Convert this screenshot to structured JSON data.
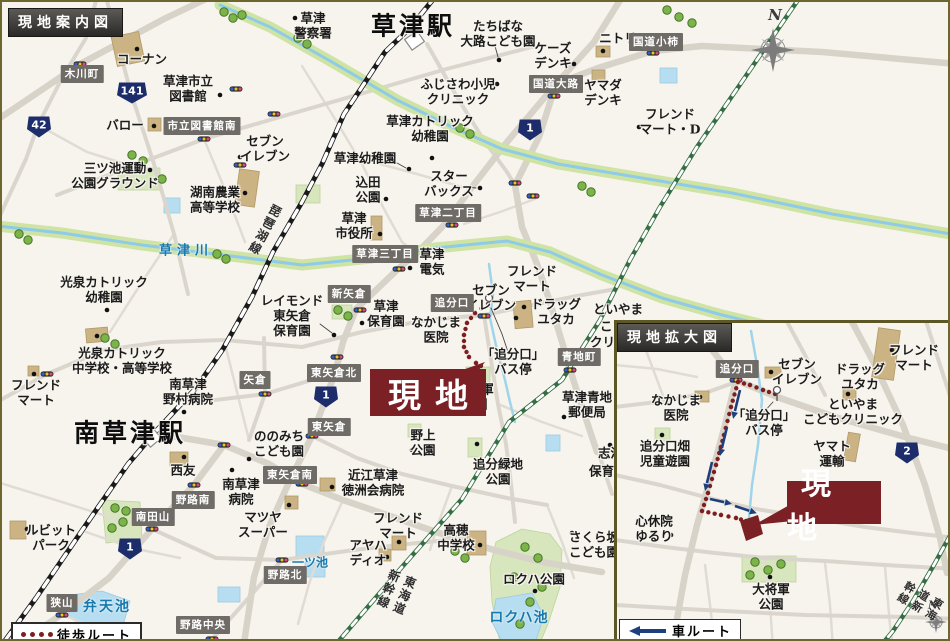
{
  "titles": {
    "main": "現地案内図",
    "inset": "現地拡大図"
  },
  "legends": {
    "walk": "徒歩ルート",
    "car": "車ルート"
  },
  "site": {
    "label": "現地"
  },
  "compass_label": "N",
  "colors": {
    "site_red": "#7b2025",
    "walk_route": "#7e1e1e",
    "car_route": "#1e3f7d",
    "shield_blue": "#1d2c6b",
    "water_text": "#1879ad",
    "river_band": "#cfe3a3",
    "rail_jr": "#1a1a1a",
    "rail_shinkansen": "#356e44"
  },
  "main_map": {
    "stations": [
      {
        "t": "草津駅",
        "x": 411,
        "y": 24
      },
      {
        "t": "南草津駅",
        "x": 128,
        "y": 431
      }
    ],
    "places": [
      {
        "lines": [
          "草津",
          "警察署"
        ],
        "x": 311,
        "y": 24
      },
      {
        "lines": [
          "たちばな",
          "大路こども園"
        ],
        "x": 496,
        "y": 32
      },
      {
        "lines": [
          "ケーズ",
          "デンキ"
        ],
        "x": 551,
        "y": 54
      },
      {
        "lines": [
          "ニトリ"
        ],
        "x": 616,
        "y": 37
      },
      {
        "lines": [
          "ヤマダ",
          "デンキ"
        ],
        "x": 601,
        "y": 91
      },
      {
        "lines": [
          "フレンド",
          "マート・D"
        ],
        "x": 668,
        "y": 120
      },
      {
        "lines": [
          "コーナン"
        ],
        "x": 140,
        "y": 58
      },
      {
        "lines": [
          "草津市立",
          "図書館"
        ],
        "x": 186,
        "y": 87
      },
      {
        "lines": [
          "バロー"
        ],
        "x": 123,
        "y": 124
      },
      {
        "lines": [
          "セブン",
          "イレブン"
        ],
        "x": 263,
        "y": 147
      },
      {
        "lines": [
          "三ツ池運動",
          "公園グラウンド"
        ],
        "x": 113,
        "y": 174
      },
      {
        "lines": [
          "湖南農業",
          "高等学校"
        ],
        "x": 213,
        "y": 198
      },
      {
        "lines": [
          "ふじさわ小児",
          "クリニック"
        ],
        "x": 456,
        "y": 90
      },
      {
        "lines": [
          "草津カトリック",
          "幼稚園"
        ],
        "x": 428,
        "y": 127
      },
      {
        "lines": [
          "草津幼稚園"
        ],
        "x": 363,
        "y": 157
      },
      {
        "lines": [
          "込田",
          "公園"
        ],
        "x": 366,
        "y": 188
      },
      {
        "lines": [
          "スター",
          "バックス"
        ],
        "x": 447,
        "y": 182
      },
      {
        "lines": [
          "草津",
          "市役所"
        ],
        "x": 352,
        "y": 224
      },
      {
        "lines": [
          "草津",
          "電気"
        ],
        "x": 430,
        "y": 260
      },
      {
        "lines": [
          "光泉カトリック",
          "幼稚園"
        ],
        "x": 102,
        "y": 288
      },
      {
        "lines": [
          "光泉カトリック",
          "中学校・高等学校"
        ],
        "x": 120,
        "y": 359
      },
      {
        "lines": [
          "フレンド",
          "マート"
        ],
        "x": 34,
        "y": 391
      },
      {
        "lines": [
          "レイモンド",
          "東矢倉",
          "保育園"
        ],
        "x": 290,
        "y": 314
      },
      {
        "lines": [
          "南草津",
          "野村病院"
        ],
        "x": 186,
        "y": 390
      },
      {
        "lines": [
          "草津",
          "保育園"
        ],
        "x": 384,
        "y": 312
      },
      {
        "lines": [
          "セブン",
          "イレブン"
        ],
        "x": 489,
        "y": 296
      },
      {
        "lines": [
          "フレンド",
          "マート"
        ],
        "x": 530,
        "y": 277
      },
      {
        "lines": [
          "ドラッグ",
          "ユタカ"
        ],
        "x": 554,
        "y": 310
      },
      {
        "lines": [
          "なかじま",
          "医院"
        ],
        "x": 434,
        "y": 328
      },
      {
        "lines": [
          "「追分口」",
          "バス停"
        ],
        "x": 511,
        "y": 360
      },
      {
        "lines": [
          "といやま"
        ],
        "x": 616,
        "y": 308
      },
      {
        "lines": [
          "こどもクリニック"
        ],
        "x": 598,
        "y": 325,
        "anchor": "left"
      },
      {
        "lines": [
          "クリニック"
        ],
        "x": 588,
        "y": 341,
        "anchor": "left"
      },
      {
        "lines": [
          "草津青地",
          "郵便局"
        ],
        "x": 585,
        "y": 403
      },
      {
        "lines": [
          "大将軍",
          "公園"
        ],
        "x": 473,
        "y": 395
      },
      {
        "lines": [
          "野上",
          "公園"
        ],
        "x": 421,
        "y": 441
      },
      {
        "lines": [
          "追分緑地",
          "公園"
        ],
        "x": 496,
        "y": 470
      },
      {
        "lines": [
          "ののみち",
          "こども園"
        ],
        "x": 277,
        "y": 442
      },
      {
        "lines": [
          "西友"
        ],
        "x": 181,
        "y": 469
      },
      {
        "lines": [
          "南草津",
          "病院"
        ],
        "x": 239,
        "y": 490
      },
      {
        "lines": [
          "マツヤ",
          "スーパー"
        ],
        "x": 261,
        "y": 523
      },
      {
        "lines": [
          "ルビット",
          "パーク"
        ],
        "x": 49,
        "y": 536
      },
      {
        "lines": [
          "近江草津",
          "徳洲会病院"
        ],
        "x": 371,
        "y": 481
      },
      {
        "lines": [
          "フレンド",
          "マート"
        ],
        "x": 396,
        "y": 524
      },
      {
        "lines": [
          "アヤハ",
          "ディオ"
        ],
        "x": 366,
        "y": 551
      },
      {
        "lines": [
          "高穂",
          "中学校"
        ],
        "x": 454,
        "y": 536
      },
      {
        "lines": [
          "さくら坂",
          "こども園"
        ],
        "x": 592,
        "y": 543
      },
      {
        "lines": [
          "志津"
        ],
        "x": 596,
        "y": 452,
        "anchor": "left"
      },
      {
        "lines": [
          "保育園"
        ],
        "x": 587,
        "y": 470,
        "anchor": "left"
      },
      {
        "lines": [
          "ロクハ公園"
        ],
        "x": 532,
        "y": 578
      }
    ],
    "boxes": [
      {
        "t": "木川町",
        "x": 80,
        "y": 72
      },
      {
        "t": "市立図書館南",
        "x": 200,
        "y": 124
      },
      {
        "t": "国道大路",
        "x": 554,
        "y": 82
      },
      {
        "t": "国道小柿",
        "x": 654,
        "y": 40
      },
      {
        "t": "草津二丁目",
        "x": 446,
        "y": 211
      },
      {
        "t": "草津三丁目",
        "x": 383,
        "y": 252
      },
      {
        "t": "新矢倉",
        "x": 347,
        "y": 292
      },
      {
        "t": "追分口",
        "x": 450,
        "y": 301
      },
      {
        "t": "青地町",
        "x": 577,
        "y": 355
      },
      {
        "t": "東矢倉北",
        "x": 332,
        "y": 371
      },
      {
        "t": "東矢倉",
        "x": 327,
        "y": 425
      },
      {
        "t": "矢倉",
        "x": 253,
        "y": 378
      },
      {
        "t": "東矢倉南",
        "x": 288,
        "y": 473
      },
      {
        "t": "野路南",
        "x": 191,
        "y": 498
      },
      {
        "t": "南田山",
        "x": 151,
        "y": 515
      },
      {
        "t": "野路北",
        "x": 283,
        "y": 573
      },
      {
        "t": "野路中央",
        "x": 201,
        "y": 623
      },
      {
        "t": "狭山",
        "x": 60,
        "y": 601
      }
    ],
    "shields": [
      {
        "n": "42",
        "x": 37,
        "y": 125
      },
      {
        "n": "141",
        "x": 130,
        "y": 91
      },
      {
        "n": "1",
        "x": 528,
        "y": 128
      },
      {
        "n": "1",
        "x": 324,
        "y": 395
      },
      {
        "n": "1",
        "x": 128,
        "y": 547
      }
    ],
    "water": [
      {
        "t": "草津川",
        "x": 184,
        "y": 247,
        "s": 13,
        "ls": 5
      },
      {
        "t": "弁天池",
        "x": 105,
        "y": 604,
        "s": 14,
        "ls": 2
      },
      {
        "t": "一ツ池",
        "x": 308,
        "y": 560,
        "s": 12,
        "ls": 0
      },
      {
        "t": "ロクハ池",
        "x": 517,
        "y": 615,
        "s": 14,
        "ls": 1
      }
    ],
    "rails": [
      {
        "t": "琵琶湖線",
        "x": 263,
        "y": 228,
        "rot": 28
      },
      {
        "t": "東海道新幹線",
        "x": 394,
        "y": 592,
        "rot": 22
      }
    ]
  },
  "inset_map": {
    "places": [
      {
        "lines": [
          "セブン",
          "イレブン"
        ],
        "x": 180,
        "y": 49
      },
      {
        "lines": [
          "フレンド",
          "マート"
        ],
        "x": 297,
        "y": 35
      },
      {
        "lines": [
          "ドラッグ",
          "ユタカ"
        ],
        "x": 243,
        "y": 54
      },
      {
        "lines": [
          "といやま",
          "こどもクリニック"
        ],
        "x": 236,
        "y": 89
      },
      {
        "lines": [
          "なかじま",
          "医院"
        ],
        "x": 59,
        "y": 85
      },
      {
        "lines": [
          "「追分口」",
          "バス停"
        ],
        "x": 147,
        "y": 100
      },
      {
        "lines": [
          "追分口畑",
          "児童遊園"
        ],
        "x": 48,
        "y": 131
      },
      {
        "lines": [
          "ヤマト",
          "運輸"
        ],
        "x": 215,
        "y": 131
      },
      {
        "lines": [
          "心休院",
          "ゆるり"
        ],
        "x": 37,
        "y": 206
      },
      {
        "lines": [
          "大将軍",
          "公園"
        ],
        "x": 154,
        "y": 274
      }
    ],
    "boxes": [
      {
        "t": "追分口",
        "x": 120,
        "y": 46
      }
    ],
    "shields": [
      {
        "n": "2",
        "x": 290,
        "y": 130
      }
    ],
    "rails": [
      {
        "t": "東海道新幹線",
        "x": 300,
        "y": 282,
        "rot": 30
      }
    ]
  }
}
